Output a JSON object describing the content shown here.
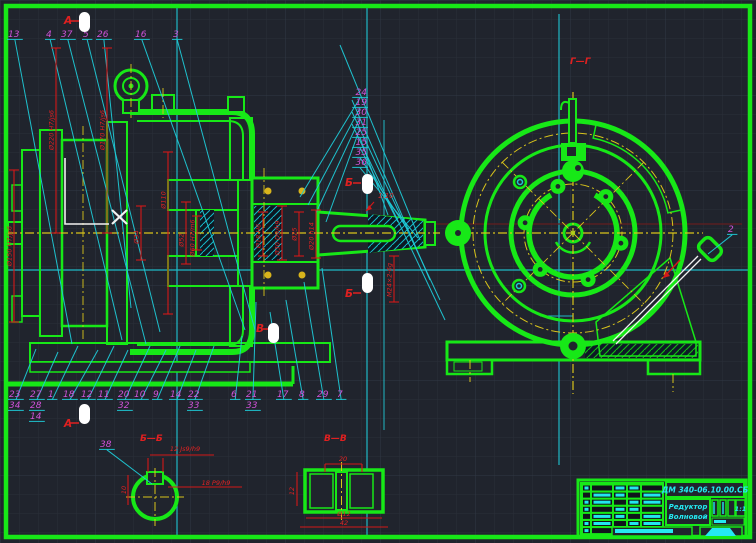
{
  "drawing": {
    "colors": {
      "background": "#20242d",
      "geometry_green": "#17e817",
      "leader_cyan": "#1fc9d6",
      "callout_magenta": "#cf52d8",
      "dimension_red": "#d41818",
      "centerline_yellow": "#d9c41b",
      "marker_white": "#ffffff",
      "title_text_cyan": "#24e9f2"
    },
    "title_block": {
      "doc_number": "ДМ 340-06.10.00.СБ",
      "part_name_line1": "Редуктор",
      "part_name_line2": "Волновой",
      "scale": "1:1"
    },
    "section_labels": {
      "gg": "Г—Г",
      "bb": "Б—Б",
      "vv": "В—В",
      "a_top": "А",
      "a_bottom": "А",
      "b_upper": "Б",
      "b_lower": "Б",
      "v_mark": "В"
    },
    "taper_label": "1:10",
    "dims": [
      {
        "t": "Ø220 H7/js6",
        "x": 56,
        "y": 130,
        "y1": 48,
        "y2": 233
      },
      {
        "t": "Ø170 H7/js6",
        "x": 107,
        "y": 130,
        "y1": 48,
        "y2": 233
      },
      {
        "t": "Ø150 H7/js6",
        "x": 14,
        "y": 246,
        "y1": 170,
        "y2": 322
      },
      {
        "t": "Ø110",
        "x": 168,
        "y": 200,
        "y1": 152,
        "y2": 314
      },
      {
        "t": "Ø34",
        "x": 141,
        "y": 237,
        "y1": 206,
        "y2": 260
      },
      {
        "t": "Ø52",
        "x": 186,
        "y": 240,
        "y1": 202,
        "y2": 264
      },
      {
        "t": "Ø60 H7/m6",
        "x": 197,
        "y": 238,
        "y1": 216,
        "y2": 250
      },
      {
        "t": "Ø18 H6",
        "x": 263,
        "y": 236,
        "y1": 212,
        "y2": 256
      },
      {
        "t": "Ø30 D9/h9",
        "x": 282,
        "y": 238,
        "y1": 206,
        "y2": 260
      },
      {
        "t": "Ø25",
        "x": 299,
        "y": 234,
        "y1": 212,
        "y2": 256
      },
      {
        "t": "Ø20 h14",
        "x": 316,
        "y": 236,
        "y1": 210,
        "y2": 258
      },
      {
        "t": "М24×2-6g",
        "x": 394,
        "y": 280,
        "y1": 256,
        "y2": 302
      }
    ],
    "detail_dims": [
      {
        "t": "12 Js9/h9",
        "x": 185,
        "y": 451
      },
      {
        "t": "18 P9/h9",
        "x": 216,
        "y": 485
      },
      {
        "t": "10",
        "x": 126,
        "y": 490,
        "rot": -90
      },
      {
        "t": "20",
        "x": 343,
        "y": 461
      },
      {
        "t": "12",
        "x": 294,
        "y": 491,
        "rot": -90
      },
      {
        "t": "Ø12",
        "x": 344,
        "y": 516
      },
      {
        "t": "42",
        "x": 344,
        "y": 525
      }
    ],
    "callouts": {
      "top": [
        {
          "t": "13",
          "x": 8,
          "ex": 72,
          "ey": 344
        },
        {
          "t": "4",
          "x": 46,
          "ex": 122,
          "ey": 340
        },
        {
          "t": "37",
          "x": 61,
          "ex": 146,
          "ey": 344
        },
        {
          "t": "5",
          "x": 83,
          "ex": 160,
          "ey": 332
        },
        {
          "t": "26",
          "x": 97,
          "ex": 131,
          "ey": 308
        },
        {
          "t": "16",
          "x": 135,
          "ex": 245,
          "ey": 330
        },
        {
          "t": "3",
          "x": 173,
          "ex": 255,
          "ey": 330
        }
      ],
      "stack": [
        {
          "t": "24",
          "x": 367,
          "y": 95,
          "ex": 300,
          "ey": 197
        },
        {
          "t": "19",
          "x": 367,
          "y": 105,
          "ex": 308,
          "ey": 205
        },
        {
          "t": "30",
          "x": 367,
          "y": 115,
          "ex": 316,
          "ey": 213
        },
        {
          "t": "31",
          "x": 367,
          "y": 125,
          "ex": 326,
          "ey": 222
        },
        {
          "t": "25",
          "x": 367,
          "y": 135,
          "ex": 388,
          "ey": 215
        },
        {
          "t": "15",
          "x": 367,
          "y": 145,
          "ex": 398,
          "ey": 222
        },
        {
          "t": "35",
          "x": 367,
          "y": 155,
          "ex": 408,
          "ey": 230
        },
        {
          "t": "36",
          "x": 367,
          "y": 165,
          "ex": 418,
          "ey": 238
        }
      ],
      "bottom": [
        {
          "t": "23",
          "x": 9,
          "y": 397,
          "ex": 36,
          "ey": 349
        },
        {
          "t": "27",
          "x": 30,
          "y": 397,
          "ex": 58,
          "ey": 352
        },
        {
          "t": "1",
          "x": 48,
          "y": 397,
          "ex": 78,
          "ey": 346
        },
        {
          "t": "18",
          "x": 63,
          "y": 397,
          "ex": 98,
          "ey": 350
        },
        {
          "t": "12",
          "x": 81,
          "y": 397,
          "ex": 114,
          "ey": 346
        },
        {
          "t": "11",
          "x": 98,
          "y": 397,
          "ex": 128,
          "ey": 350
        },
        {
          "t": "20",
          "x": 118,
          "y": 397,
          "ex": 150,
          "ey": 346
        },
        {
          "t": "10",
          "x": 134,
          "y": 397,
          "ex": 166,
          "ey": 350
        },
        {
          "t": "9",
          "x": 153,
          "y": 397,
          "ex": 180,
          "ey": 346
        },
        {
          "t": "14",
          "x": 170,
          "y": 397,
          "ex": 196,
          "ey": 350
        },
        {
          "t": "22",
          "x": 188,
          "y": 397,
          "ex": 214,
          "ey": 346
        },
        {
          "t": "6",
          "x": 231,
          "y": 397,
          "ex": 242,
          "ey": 336
        },
        {
          "t": "21",
          "x": 246,
          "y": 397,
          "ex": 256,
          "ey": 302
        },
        {
          "t": "17",
          "x": 277,
          "y": 397,
          "ex": 270,
          "ey": 312
        },
        {
          "t": "8",
          "x": 299,
          "y": 397,
          "ex": 286,
          "ey": 300
        },
        {
          "t": "29",
          "x": 317,
          "y": 397,
          "ex": 304,
          "ey": 282
        },
        {
          "t": "7",
          "x": 337,
          "y": 397,
          "ex": 322,
          "ey": 268
        },
        {
          "t": "34",
          "x": 9,
          "y": 408
        },
        {
          "t": "28",
          "x": 30,
          "y": 408
        },
        {
          "t": "32",
          "x": 118,
          "y": 408
        },
        {
          "t": "33",
          "x": 188,
          "y": 408
        },
        {
          "t": "33",
          "x": 246,
          "y": 408
        },
        {
          "t": "14",
          "x": 30,
          "y": 419
        }
      ],
      "other": [
        {
          "t": "38",
          "x": 100,
          "y": 447,
          "ex": 152,
          "ey": 484
        },
        {
          "t": "2",
          "x": 728,
          "y": 232,
          "ex": 708,
          "ey": 254
        }
      ],
      "fan_lines": [
        [
          352,
          100,
          430,
          280
        ],
        [
          352,
          112,
          440,
          300
        ],
        [
          352,
          124,
          445,
          320
        ],
        [
          340,
          45,
          420,
          240
        ]
      ]
    }
  }
}
